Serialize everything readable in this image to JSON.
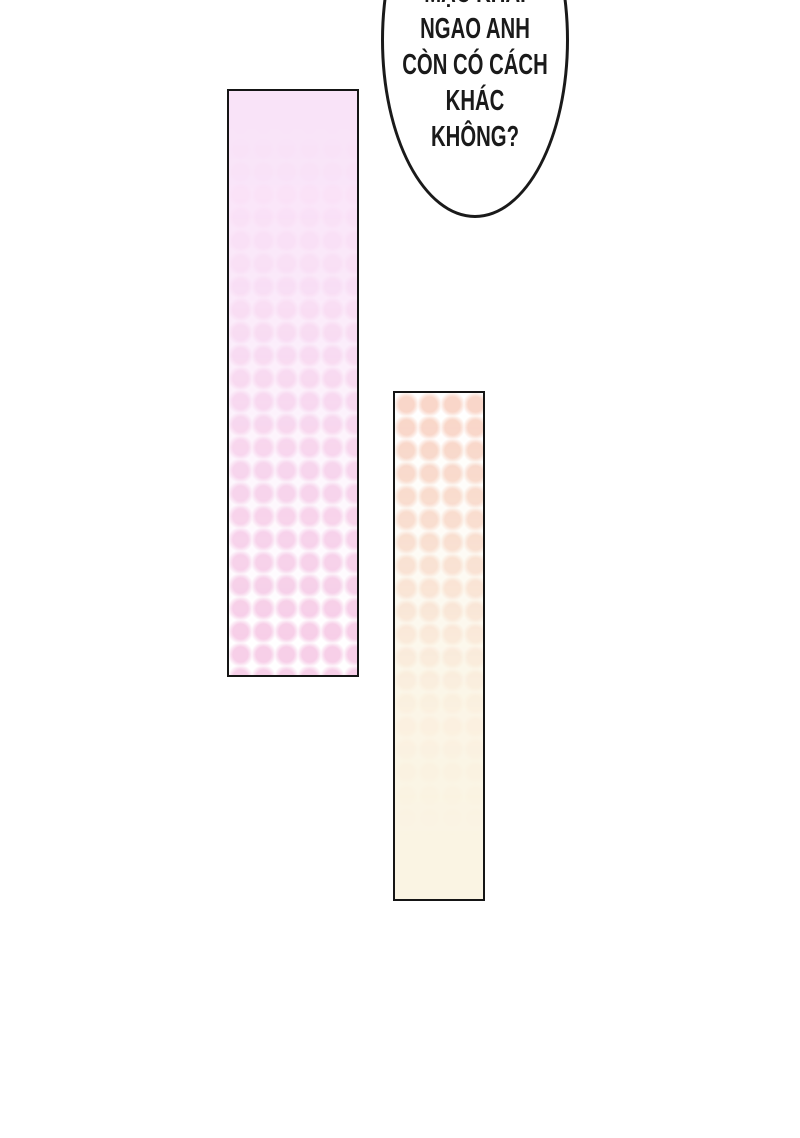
{
  "page": {
    "type": "comic-page",
    "width": 800,
    "height": 1138,
    "background": "#ffffff"
  },
  "speech_bubble": {
    "full_text": "MẠC KHẢI NGAO ANH CÒN CÓ CÁCH KHÁC KHÔNG?",
    "lines": [
      "MẠC KHẢI",
      "NGAO ANH",
      "CÒN CÓ CÁCH",
      "KHÁC",
      "KHÔNG?"
    ],
    "note": "first line partially cropped by top edge of image"
  },
  "colors": {
    "ink": "#1a1a1a",
    "bubble-fill": "#ffffff",
    "panel-border": "#151515",
    "pink-dot": "#f7cfe8",
    "pink-solid": "#f9e3f8",
    "peach-dot": "#f9d6c9",
    "cream-solid": "#faf4e3"
  }
}
